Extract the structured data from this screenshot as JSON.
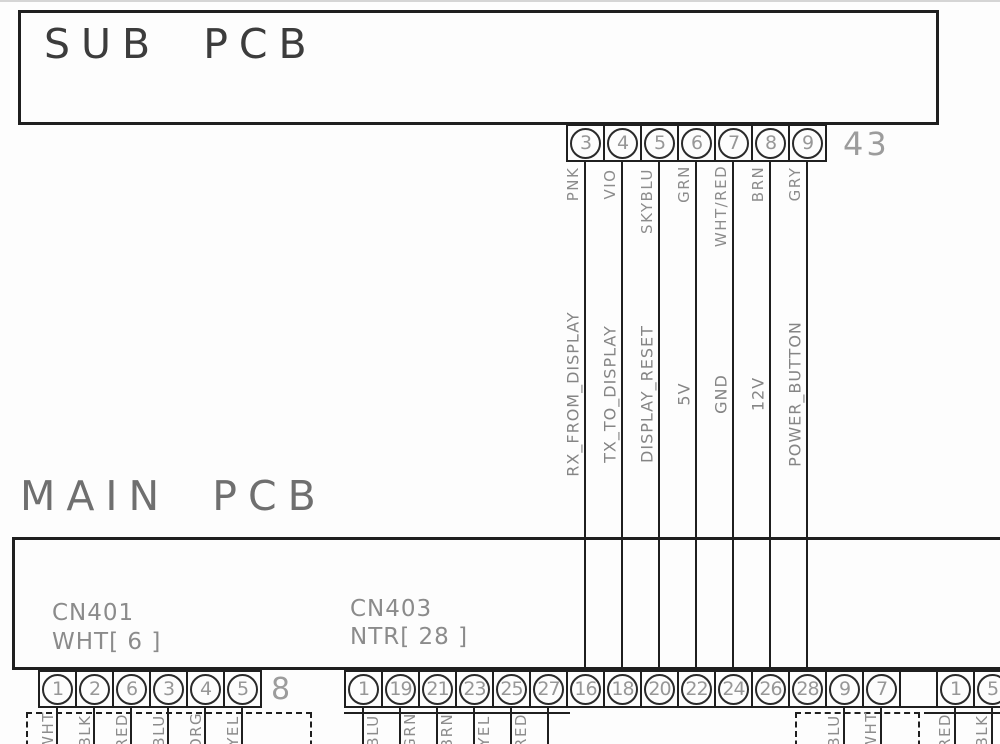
{
  "sub_pcb": {
    "title": "SUB PCB"
  },
  "main_pcb": {
    "title": "MAIN PCB"
  },
  "sub_connector": {
    "pins": [
      "3",
      "4",
      "5",
      "6",
      "7",
      "8",
      "9"
    ],
    "ref_label": "43",
    "wire_colors": [
      "PNK",
      "VIO",
      "SKYBLU",
      "GRN",
      "WHT/RED",
      "BRN",
      "GRY"
    ]
  },
  "signals": [
    "RX_FROM_DISPLAY",
    "TX_TO_DISPLAY",
    "DISPLAY_RESET",
    "5V",
    "GND",
    "12V",
    "POWER_BUTTON"
  ],
  "cn401": {
    "name": "CN401",
    "spec": "WHT[ 6 ]",
    "pins": [
      "1",
      "2",
      "6",
      "3",
      "4",
      "5"
    ],
    "ref_label": "8",
    "wire_colors": [
      "WHT",
      "BLK",
      "RED",
      "BLU",
      "ORG",
      "YEL"
    ]
  },
  "cn403": {
    "name": "CN403",
    "spec": "NTR[ 28 ]",
    "pins_down": [
      "1",
      "19",
      "21",
      "23",
      "25",
      "27"
    ],
    "wire_colors_down": [
      "BLU",
      "GRN",
      "BRN",
      "YEL",
      "RED"
    ],
    "pins_up": [
      "16",
      "18",
      "20",
      "22",
      "24",
      "26",
      "28"
    ],
    "pins_aux": [
      "9",
      "7"
    ],
    "wire_colors_aux": [
      "BLU",
      "WHT"
    ],
    "pins_right": [
      "1",
      "5"
    ],
    "wire_colors_right": [
      "RED",
      "BLK"
    ]
  }
}
